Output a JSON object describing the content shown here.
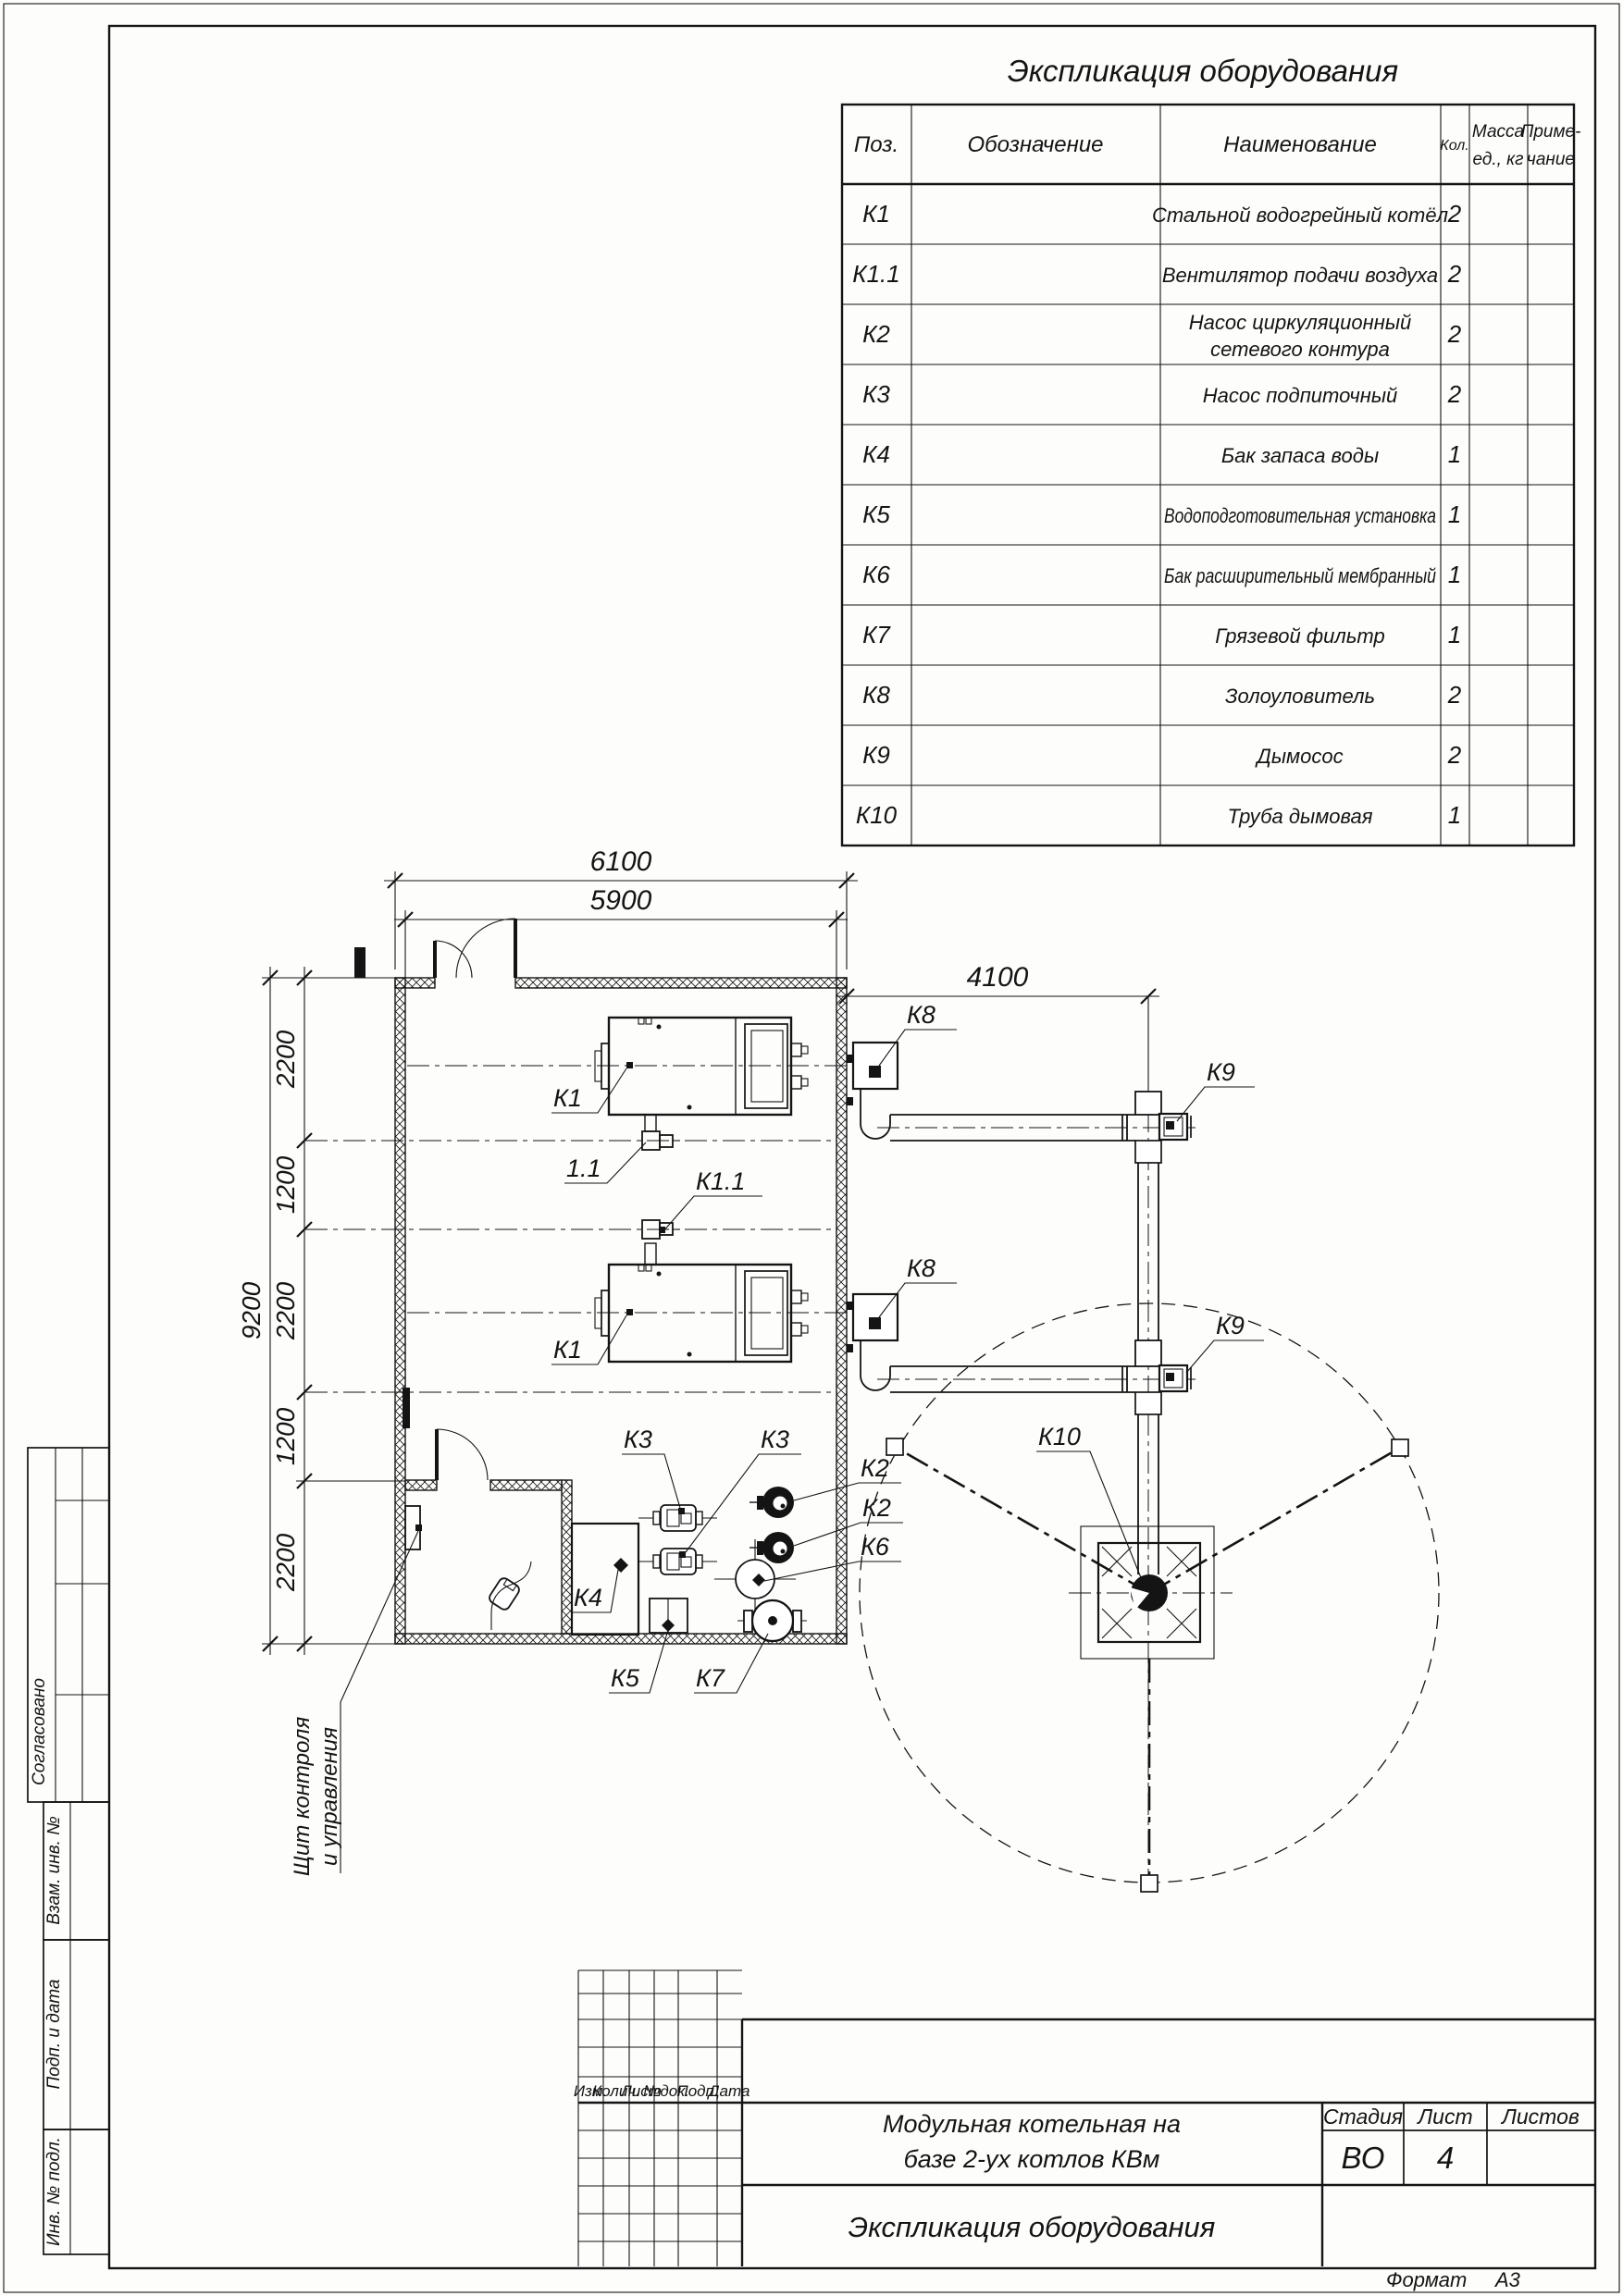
{
  "sheet": {
    "title": "Экспликация оборудования",
    "format_label": "Формат",
    "format_value": "А3"
  },
  "spec_table": {
    "headers": {
      "pos": "Поз.",
      "designation": "Обозначение",
      "name": "Наименование",
      "qty": "Кол.",
      "mass_l1": "Масса",
      "mass_l2": "ед., кг",
      "note_l1": "Приме-",
      "note_l2": "чание"
    },
    "rows": [
      {
        "pos": "К1",
        "name": "Стальной водогрейный котёл",
        "qty": "2"
      },
      {
        "pos": "К1.1",
        "name": "Вентилятор подачи воздуха",
        "qty": "2"
      },
      {
        "pos": "К2",
        "name1": "Насос циркуляционный",
        "name2": "сетевого контура",
        "qty": "2"
      },
      {
        "pos": "К3",
        "name": "Насос подпиточный",
        "qty": "2"
      },
      {
        "pos": "К4",
        "name": "Бак запаса воды",
        "qty": "1"
      },
      {
        "pos": "К5",
        "name": "Водоподготовительная установка",
        "qty": "1"
      },
      {
        "pos": "К6",
        "name": "Бак расширительный мембранный",
        "qty": "1"
      },
      {
        "pos": "К7",
        "name": "Грязевой фильтр",
        "qty": "1"
      },
      {
        "pos": "К8",
        "name": "Золоуловитель",
        "qty": "2"
      },
      {
        "pos": "К9",
        "name": "Дымосос",
        "qty": "2"
      },
      {
        "pos": "К10",
        "name": "Труба дымовая",
        "qty": "1"
      }
    ]
  },
  "plan": {
    "dims": {
      "w_out": "6100",
      "w_in": "5900",
      "flue": "4100",
      "h_total": "9200",
      "s1": "2200",
      "s2": "1200",
      "s3": "2200",
      "s4": "1200",
      "s5": "2200"
    },
    "labels": {
      "k1a": "К1",
      "k1b": "К1",
      "k11a": "1.1",
      "k11b": "К1.1",
      "k2a": "К2",
      "k2b": "К2",
      "k3a": "К3",
      "k3b": "К3",
      "k4": "К4",
      "k5": "К5",
      "k6": "К6",
      "k7": "К7",
      "k8a": "К8",
      "k8b": "К8",
      "k9a": "К9",
      "k9b": "К9",
      "k10": "К10"
    },
    "annotations": {
      "panel_l1": "Щит контроля",
      "panel_l2": "и управления"
    }
  },
  "title_block": {
    "rev_headers": [
      "Изм.",
      "Колич.",
      "Лист",
      "№док.",
      "Подп.",
      "Дата"
    ],
    "project_l1": "Модульная котельная на",
    "project_l2": "базе 2-ух котлов КВм",
    "doc_title": "Экспликация оборудования",
    "stage_label": "Стадия",
    "sheet_label": "Лист",
    "sheets_label": "Листов",
    "stage_value": "ВО",
    "sheet_value": "4",
    "sheets_value": ""
  },
  "side_stamps": {
    "agreed": "Согласовано",
    "vzam": "Взам. инв. №",
    "podp": "Подп. и дата",
    "inv": "Инв. № подл."
  }
}
